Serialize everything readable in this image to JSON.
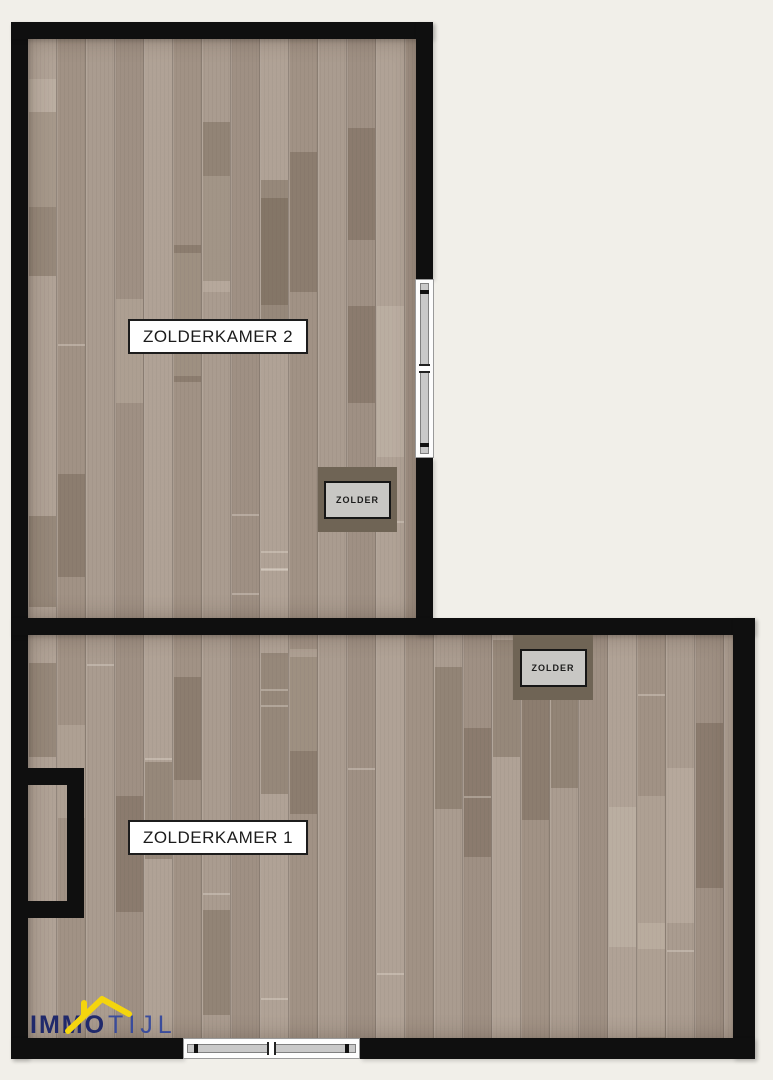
{
  "plan": {
    "background_color": "#f1efe9",
    "wall_color": "#0f0f0f",
    "floor_base_color": "#a99b8f",
    "rooms": [
      {
        "label": "ZOLDERKAMER 2"
      },
      {
        "label": "ZOLDERKAMER 1"
      }
    ],
    "hatches": [
      {
        "label": "ZOLDER"
      },
      {
        "label": "ZOLDER"
      }
    ],
    "window_colors": {
      "frame": "#fdfdfd",
      "glass": "#c9c9c9"
    }
  },
  "logo": {
    "text_bold": "IMMO",
    "text_light": "TIJL",
    "color_bold": "#20296b",
    "color_light": "#3a4c9c",
    "roof_color": "#f4d50e"
  }
}
